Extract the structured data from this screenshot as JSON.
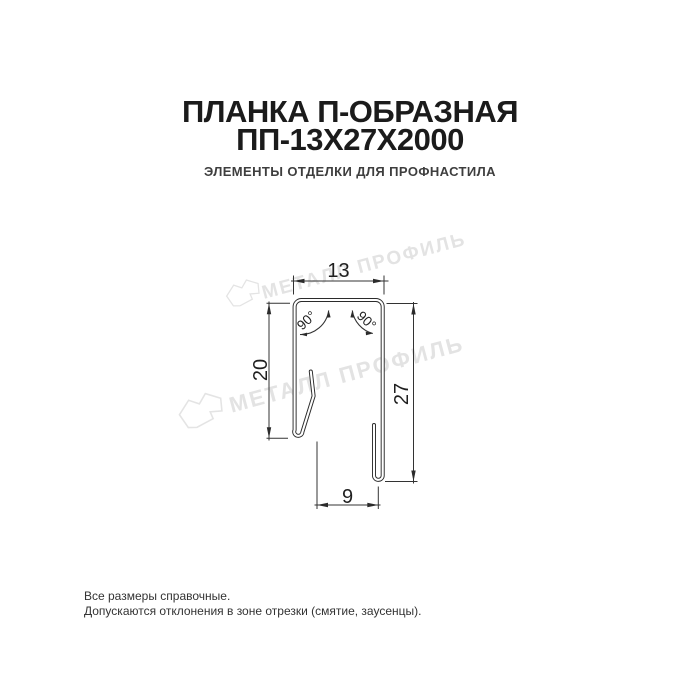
{
  "header": {
    "title_line1": "ПЛАНКА П-ОБРАЗНАЯ",
    "title_line2": "ПП-13Х27Х2000",
    "subtitle": "ЭЛЕМЕНТЫ ОТДЕЛКИ ДЛЯ ПРОФНАСТИЛА",
    "title_color": "#1b1b1b",
    "subtitle_color": "#3e3e3e"
  },
  "diagram": {
    "type": "technical-profile-cross-section",
    "dimensions": {
      "top_width": "13",
      "left_height": "20",
      "right_height": "27",
      "bottom_width": "9",
      "angle_left": "90°",
      "angle_right": "90°"
    },
    "line_color": "#2f2f2f"
  },
  "watermark": {
    "text": "МЕТАЛЛ ПРОФИЛЬ",
    "color": "#e3e3e3"
  },
  "footer": {
    "line1": "Все размеры справочные.",
    "line2": "Допускаются отклонения в зоне отрезки (смятие, заусенцы).",
    "color": "#333333"
  }
}
